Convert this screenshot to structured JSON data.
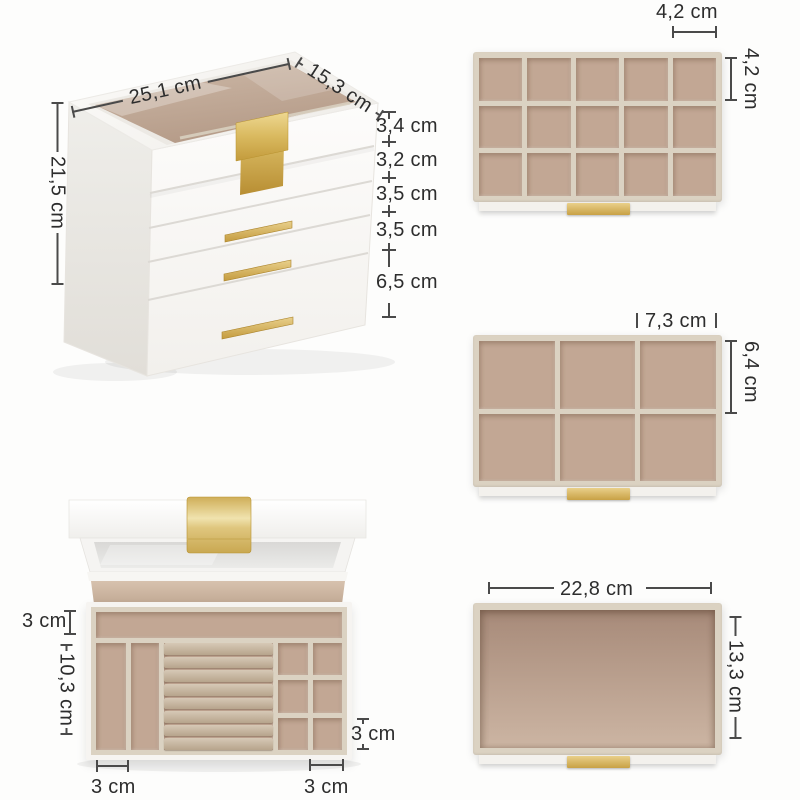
{
  "palette": {
    "background": "#fdfdfc",
    "dim": "#4a4a4a",
    "text": "#2d2d2d",
    "gold": "#cfa243",
    "velvet": "#c2a794",
    "cream": "#dbd2c2",
    "box_white": "#faf9f7"
  },
  "views": {
    "closed_box": {
      "dimensions": {
        "width": "25,1 cm",
        "depth": "15,3 cm",
        "height": "21,5 cm",
        "layers": [
          "3,4 cm",
          "3,2 cm",
          "3,5 cm",
          "3,5 cm",
          "6,5 cm"
        ]
      }
    },
    "small_compartment_tray": {
      "grid": {
        "rows": 3,
        "columns": 5
      },
      "dimensions": {
        "compartment_width": "4,2 cm",
        "compartment_height": "4,2 cm"
      }
    },
    "large_compartment_tray": {
      "grid": {
        "rows": 2,
        "columns": 3
      },
      "dimensions": {
        "compartment_width": "7,3 cm",
        "compartment_height": "6,4 cm"
      }
    },
    "deep_drawer": {
      "dimensions": {
        "width": "22,8 cm",
        "depth": "13,3 cm"
      }
    },
    "open_top_tray": {
      "dimensions": {
        "back_compartment_depth": "3 cm",
        "tray_depth": "10,3 cm",
        "left_slot_width": "3 cm",
        "small_compartment_height": "3 cm",
        "small_compartment_width": "3 cm"
      }
    }
  }
}
